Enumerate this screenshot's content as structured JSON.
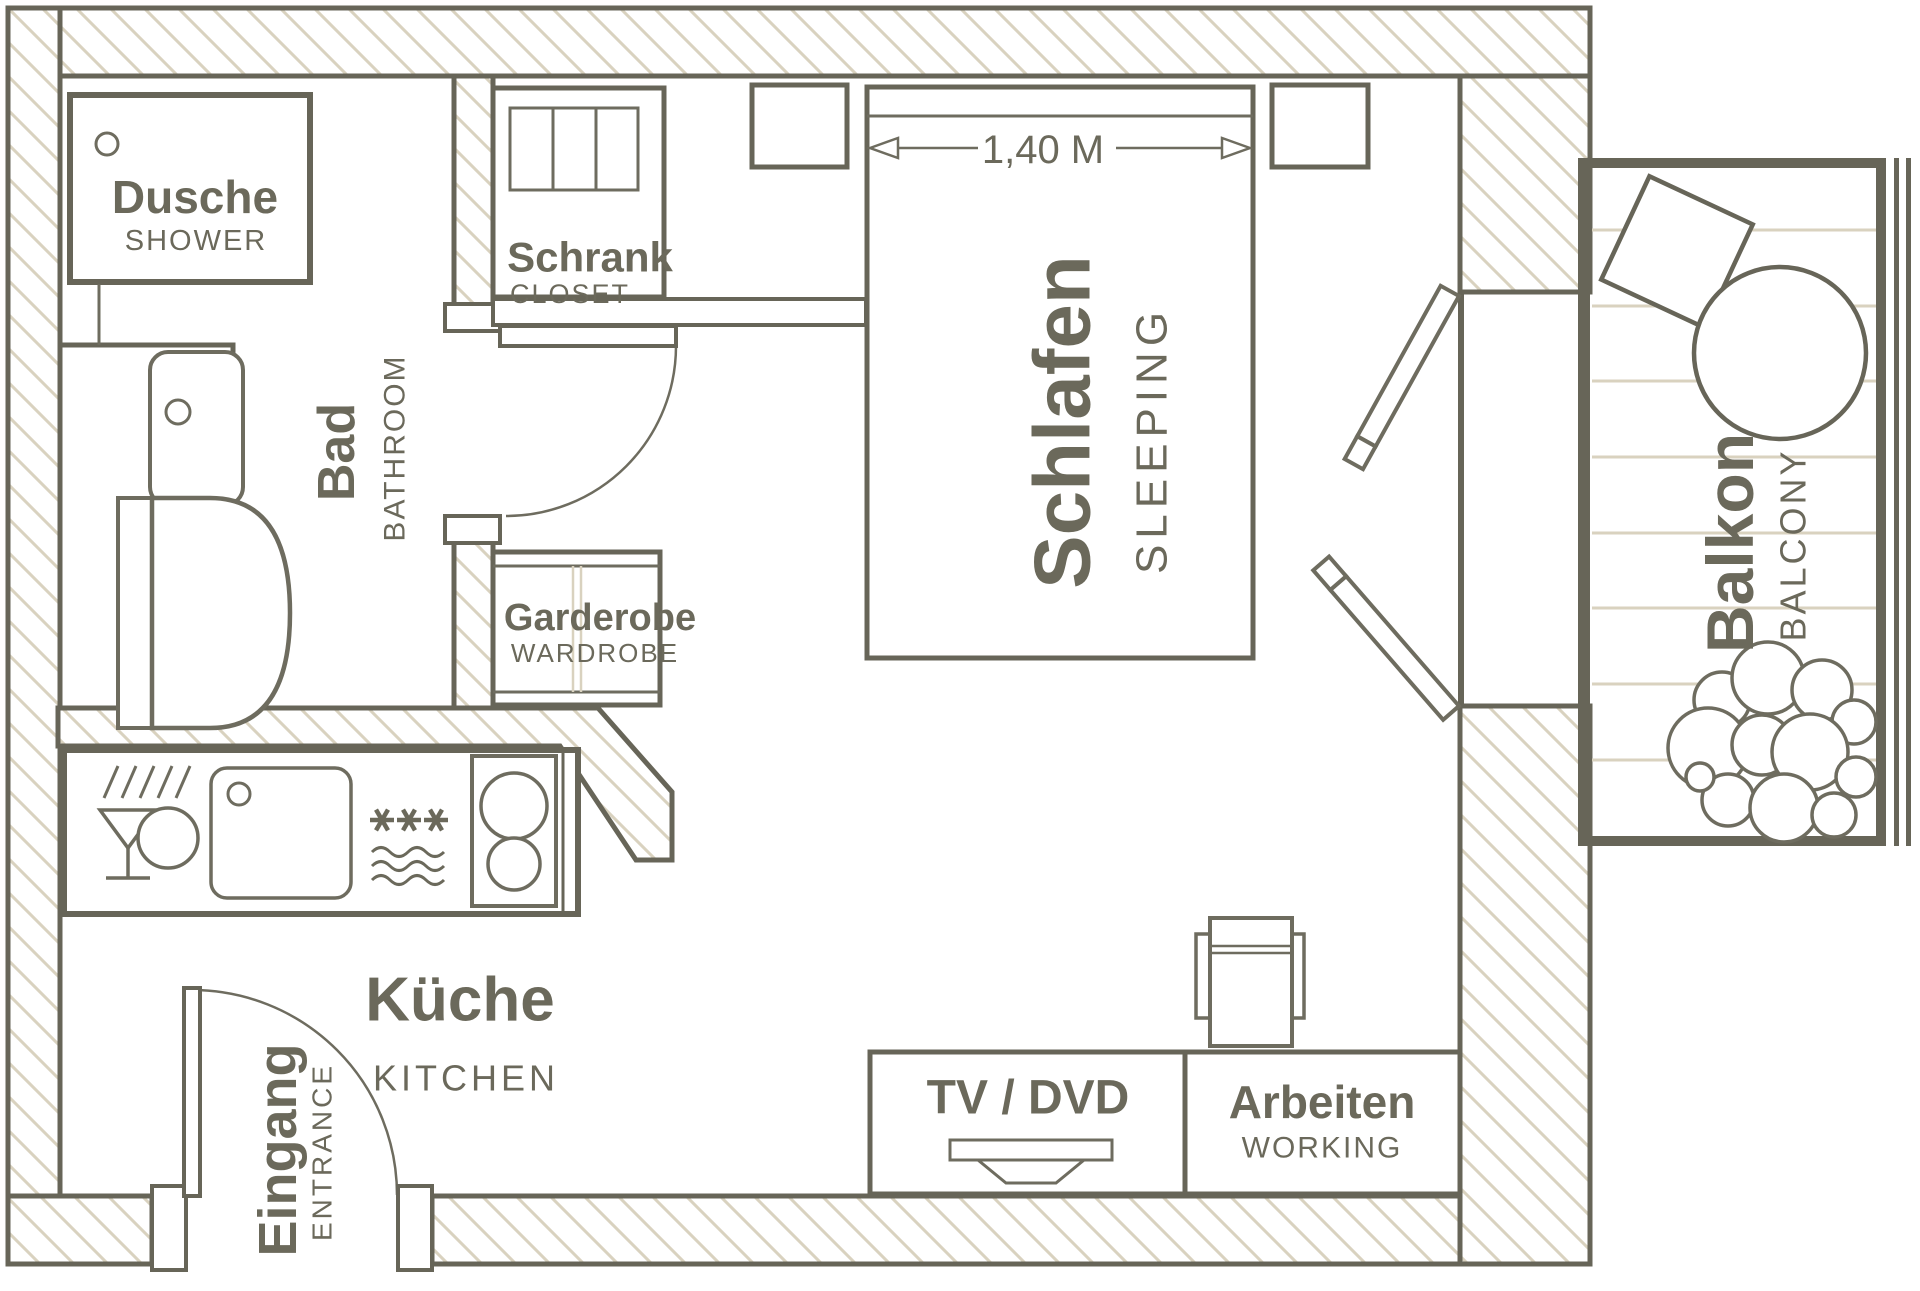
{
  "rooms": {
    "shower": {
      "label": "Dusche",
      "sublabel": "SHOWER"
    },
    "closet": {
      "label": "Schrank",
      "sublabel": "CLOSET"
    },
    "bathroom": {
      "label": "Bad",
      "sublabel": "BATHROOM"
    },
    "wardrobe": {
      "label": "Garderobe",
      "sublabel": "WARDROBE"
    },
    "sleeping": {
      "label": "Schlafen",
      "sublabel": "SLEEPING"
    },
    "balcony": {
      "label": "Balkon",
      "sublabel": "BALCONY"
    },
    "kitchen": {
      "label": "Küche",
      "sublabel": "KITCHEN"
    },
    "entrance": {
      "label": "Eingang",
      "sublabel": "ENTRANCE"
    },
    "media": {
      "label": "TV / DVD"
    },
    "work": {
      "label": "Arbeiten",
      "sublabel": "WORKING"
    }
  },
  "dimensions": {
    "bed_width": "1,40 M"
  },
  "colors": {
    "line": "#676558",
    "hatch": "#d9d2bf",
    "text": "#6b695b",
    "background": "#ffffff"
  }
}
